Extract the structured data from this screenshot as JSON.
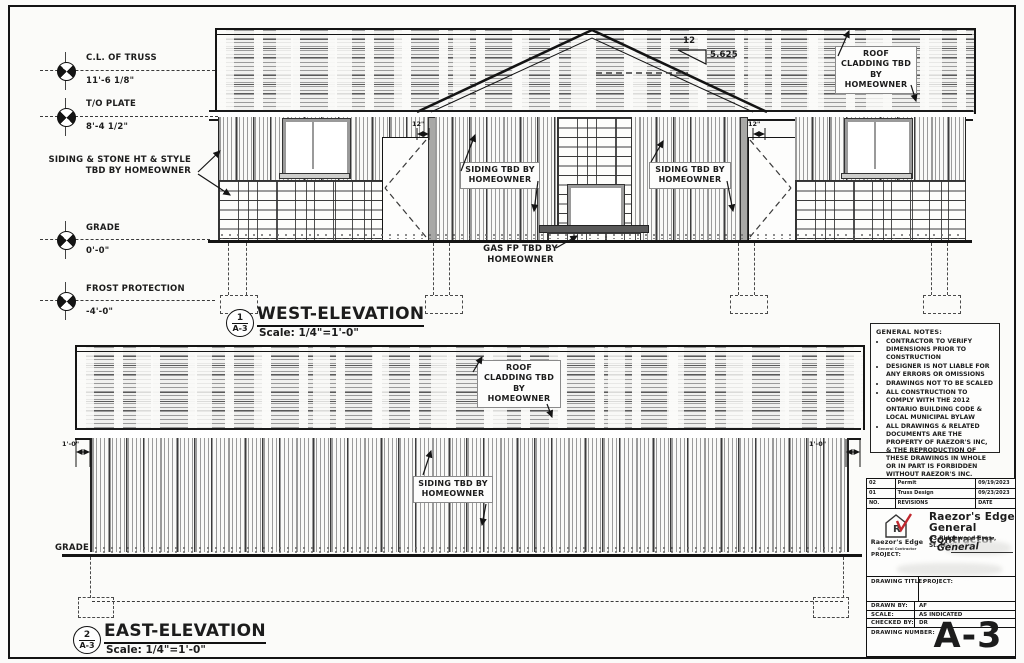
{
  "colors": {
    "logo_red": "#c0272d",
    "ink": "#141414"
  },
  "west": {
    "datums": [
      {
        "label": "C.L. OF TRUSS",
        "value": "11'-6 1/8\""
      },
      {
        "label": "T/O PLATE",
        "value": "8'-4 1/2\""
      },
      {
        "label": "GRADE",
        "value": "0'-0\""
      },
      {
        "label": "FROST PROTECTION",
        "value": "-4'-0\""
      }
    ],
    "siding_stone_note": "SIDING & STONE HT & STYLE\nTBD BY HOMEOWNER",
    "slope_rise": "12",
    "slope_run": "5.625",
    "roof_note": "ROOF\nCLADDING TBD\nBY\nHOMEOWNER",
    "siding_note_left": "SIDING TBD BY\nHOMEOWNER",
    "siding_note_right": "SIDING TBD BY\nHOMEOWNER",
    "gas_note": "GAS FP TBD BY\nHOMEOWNER",
    "door_dim_left": "12\"",
    "door_dim_right": "12\"",
    "callout_number": "1",
    "callout_sheet": "A-3",
    "title": "WEST-ELEVATION",
    "scale": "Scale:  1/4\"=1'-0\""
  },
  "east": {
    "roof_note": "ROOF\nCLADDING TBD\nBY\nHOMEOWNER",
    "siding_note": "SIDING TBD BY\nHOMEOWNER",
    "grade_label": "GRADE",
    "dim_left": "1'-0\"",
    "dim_right": "1'-0\"",
    "callout_number": "2",
    "callout_sheet": "A-3",
    "title": "EAST-ELEVATION",
    "scale": "Scale:  1/4\"=1'-0\""
  },
  "notes": {
    "title": "GENERAL NOTES:",
    "items": [
      "CONTRACTOR TO VERIFY DIMENSIONS PRIOR TO CONSTRUCTION",
      "DESIGNER IS NOT LIABLE FOR ANY ERRORS OR OMISSIONS",
      "DRAWINGS NOT TO BE SCALED",
      "ALL CONSTRUCTION TO COMPLY WITH THE 2012 ONTARIO BUILDING CODE & LOCAL MUNICIPAL BYLAW",
      "ALL DRAWINGS & RELATED DOCUMENTS ARE THE PROPERTY OF RAEZOR'S INC, & THE REPRODUCTION OF THESE DRAWINGS IN WHOLE OR IN PART IS FORBIDDEN WITHOUT RAEZOR'S INC. PERMISSION"
    ]
  },
  "titleblock": {
    "revisions": {
      "rows": [
        {
          "no": "02",
          "desc": "Permit",
          "date": "09/19/2023"
        },
        {
          "no": "01",
          "desc": "Truss Design",
          "date": "09/23/2023"
        }
      ],
      "header": {
        "no": "NO.",
        "desc": "REVISIONS",
        "date": "DATE"
      }
    },
    "logo_letter": "R",
    "logo_name": "Raezor's Edge",
    "logo_sub": "General Contractor",
    "company_line1": "Raezor's Edge",
    "company_line2": "General Contractor",
    "address_line1": "43 Ridgewood Cres.,",
    "address_line2": "St. Marys, On.",
    "handwritten": "General",
    "project_label": "PROJECT:",
    "drawing_title_label": "DRAWING TITLE:",
    "project_label2": "PROJECT:",
    "drawn_by_label": "DRAWN BY:",
    "drawn_by": "AF",
    "scale_label": "SCALE:",
    "scale_value": "AS INDICATED",
    "checked_by_label": "CHECKED BY:",
    "checked_by": "DR",
    "drawing_number_label": "DRAWING NUMBER:",
    "drawing_number": "A-3"
  }
}
